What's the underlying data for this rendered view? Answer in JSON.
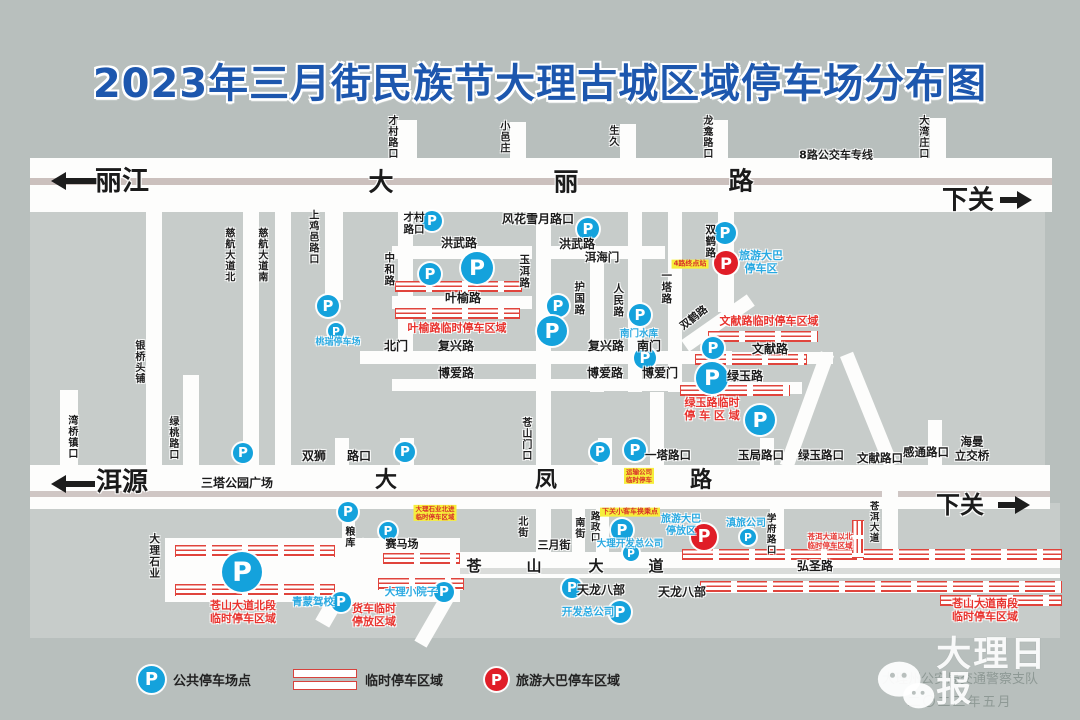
{
  "title": "2023年三月街民族节大理古城区域停车场分布图",
  "colors": {
    "accent_blue": "#1d57ae",
    "parking_blue": "#14a2dc",
    "bus_red": "#e01d27",
    "temp_zone_red": "#e8332e",
    "highlight_yellow": "#f6ee3b",
    "road_white": "#fdfdfc",
    "block_gray": "#c7ccca",
    "background": "#b8bfbd"
  },
  "legend": {
    "items": [
      {
        "icon": "blue-p",
        "label": "公共停车场点"
      },
      {
        "icon": "hatch",
        "label": "临时停车区域"
      },
      {
        "icon": "red-p",
        "label": "旅游大巴停车区域"
      }
    ]
  },
  "footer": {
    "watermark": "大理日报",
    "credit": "大理州公安局交通警察支队",
    "date": "二〇二三年五月"
  },
  "map": {
    "blocks": [
      {
        "x": 30,
        "y": 212,
        "w": 330,
        "h": 253
      },
      {
        "x": 360,
        "y": 212,
        "w": 360,
        "h": 253
      },
      {
        "x": 720,
        "y": 212,
        "w": 325,
        "h": 253
      },
      {
        "x": 30,
        "y": 503,
        "w": 1030,
        "h": 135
      }
    ],
    "roads": [
      {
        "x": 397,
        "y": 120,
        "w": 20,
        "h": 38
      },
      {
        "x": 510,
        "y": 122,
        "w": 16,
        "h": 36
      },
      {
        "x": 620,
        "y": 124,
        "w": 16,
        "h": 34
      },
      {
        "x": 712,
        "y": 120,
        "w": 16,
        "h": 38
      },
      {
        "x": 930,
        "y": 118,
        "w": 16,
        "h": 40
      },
      {
        "x": 30,
        "y": 158,
        "w": 1022,
        "h": 54,
        "stripe": {
          "top": 20,
          "h": 7,
          "color": "#cbc0bd"
        }
      },
      {
        "x": 392,
        "y": 246,
        "w": 140,
        "h": 13
      },
      {
        "x": 540,
        "y": 246,
        "w": 125,
        "h": 13
      },
      {
        "x": 392,
        "y": 296,
        "w": 140,
        "h": 13
      },
      {
        "x": 360,
        "y": 351,
        "w": 372,
        "h": 13
      },
      {
        "x": 688,
        "y": 352,
        "w": 145,
        "h": 12
      },
      {
        "x": 392,
        "y": 379,
        "w": 288,
        "h": 12
      },
      {
        "x": 680,
        "y": 382,
        "w": 122,
        "h": 12
      },
      {
        "x": 398,
        "y": 212,
        "w": 15,
        "h": 140
      },
      {
        "x": 536,
        "y": 212,
        "w": 15,
        "h": 255
      },
      {
        "x": 590,
        "y": 246,
        "w": 14,
        "h": 146
      },
      {
        "x": 628,
        "y": 212,
        "w": 14,
        "h": 180
      },
      {
        "x": 668,
        "y": 212,
        "w": 14,
        "h": 180
      },
      {
        "x": 650,
        "y": 392,
        "w": 14,
        "h": 75
      },
      {
        "x": 718,
        "y": 212,
        "w": 16,
        "h": 100
      },
      {
        "x": 678,
        "y": 316,
        "w": 80,
        "h": 14,
        "rot": -35
      },
      {
        "x": 60,
        "y": 390,
        "w": 18,
        "h": 77
      },
      {
        "x": 146,
        "y": 212,
        "w": 16,
        "h": 255
      },
      {
        "x": 183,
        "y": 375,
        "w": 16,
        "h": 92
      },
      {
        "x": 243,
        "y": 212,
        "w": 16,
        "h": 255
      },
      {
        "x": 275,
        "y": 212,
        "w": 16,
        "h": 255
      },
      {
        "x": 325,
        "y": 212,
        "w": 18,
        "h": 88
      },
      {
        "x": 335,
        "y": 438,
        "w": 14,
        "h": 29
      },
      {
        "x": 400,
        "y": 438,
        "w": 14,
        "h": 29
      },
      {
        "x": 598,
        "y": 438,
        "w": 14,
        "h": 29
      },
      {
        "x": 760,
        "y": 438,
        "w": 14,
        "h": 29
      },
      {
        "x": 928,
        "y": 420,
        "w": 14,
        "h": 47
      },
      {
        "x": 342,
        "y": 503,
        "w": 13,
        "h": 45
      },
      {
        "x": 800,
        "y": 350,
        "w": 14,
        "h": 120,
        "rot": 20
      },
      {
        "x": 862,
        "y": 350,
        "w": 14,
        "h": 120,
        "rot": -22
      },
      {
        "x": 30,
        "y": 465,
        "w": 1020,
        "h": 44,
        "stripe": {
          "top": 26,
          "h": 6,
          "color": "#cfc6c4"
        }
      },
      {
        "x": 536,
        "y": 503,
        "w": 15,
        "h": 50
      },
      {
        "x": 572,
        "y": 509,
        "w": 13,
        "h": 44
      },
      {
        "x": 596,
        "y": 509,
        "w": 13,
        "h": 44
      },
      {
        "x": 770,
        "y": 509,
        "w": 14,
        "h": 44
      },
      {
        "x": 882,
        "y": 467,
        "w": 16,
        "h": 90
      },
      {
        "x": 460,
        "y": 552,
        "w": 600,
        "h": 26,
        "stripe": {
          "top": 16,
          "h": 6,
          "color": "#dadcda"
        }
      },
      {
        "x": 165,
        "y": 538,
        "w": 295,
        "h": 64
      },
      {
        "x": 338,
        "y": 535,
        "w": 16,
        "h": 95,
        "rot": 30
      },
      {
        "x": 428,
        "y": 590,
        "w": 14,
        "h": 58,
        "rot": 30
      }
    ],
    "hatches": [
      {
        "x": 395,
        "y": 281,
        "w": 125,
        "h": 11
      },
      {
        "x": 395,
        "y": 308,
        "w": 123,
        "h": 11
      },
      {
        "x": 708,
        "y": 331,
        "w": 108,
        "h": 11
      },
      {
        "x": 695,
        "y": 354,
        "w": 110,
        "h": 11
      },
      {
        "x": 680,
        "y": 385,
        "w": 108,
        "h": 11
      },
      {
        "x": 175,
        "y": 545,
        "w": 158,
        "h": 12
      },
      {
        "x": 383,
        "y": 553,
        "w": 75,
        "h": 11
      },
      {
        "x": 175,
        "y": 584,
        "w": 158,
        "h": 12
      },
      {
        "x": 378,
        "y": 578,
        "w": 84,
        "h": 12
      },
      {
        "x": 682,
        "y": 549,
        "w": 378,
        "h": 11
      },
      {
        "x": 700,
        "y": 581,
        "w": 360,
        "h": 12
      },
      {
        "x": 940,
        "y": 595,
        "w": 120,
        "h": 11
      },
      {
        "x": 852,
        "y": 520,
        "w": 12,
        "h": 36,
        "v": 1
      }
    ],
    "arrows": [
      {
        "x": 57,
        "y": 178,
        "len": 40,
        "dir": "left"
      },
      {
        "x": 57,
        "y": 481,
        "len": 38,
        "dir": "left"
      },
      {
        "x": 1000,
        "y": 197,
        "len": 26,
        "dir": "right"
      },
      {
        "x": 998,
        "y": 502,
        "len": 26,
        "dir": "right"
      }
    ],
    "p_icons": [
      {
        "x": 432,
        "y": 221,
        "r": 10
      },
      {
        "x": 588,
        "y": 229,
        "r": 11
      },
      {
        "x": 725,
        "y": 233,
        "r": 11
      },
      {
        "x": 430,
        "y": 274,
        "r": 11
      },
      {
        "x": 477,
        "y": 268,
        "r": 16
      },
      {
        "x": 328,
        "y": 306,
        "r": 11
      },
      {
        "x": 336,
        "y": 331,
        "r": 8
      },
      {
        "x": 558,
        "y": 306,
        "r": 11
      },
      {
        "x": 552,
        "y": 331,
        "r": 15
      },
      {
        "x": 640,
        "y": 315,
        "r": 11
      },
      {
        "x": 645,
        "y": 358,
        "r": 11
      },
      {
        "x": 712,
        "y": 378,
        "r": 16
      },
      {
        "x": 243,
        "y": 453,
        "r": 10
      },
      {
        "x": 405,
        "y": 452,
        "r": 10
      },
      {
        "x": 600,
        "y": 452,
        "r": 10
      },
      {
        "x": 635,
        "y": 450,
        "r": 11
      },
      {
        "x": 713,
        "y": 348,
        "r": 11
      },
      {
        "x": 760,
        "y": 420,
        "r": 15
      },
      {
        "x": 348,
        "y": 512,
        "r": 10
      },
      {
        "x": 388,
        "y": 531,
        "r": 9
      },
      {
        "x": 242,
        "y": 572,
        "r": 20
      },
      {
        "x": 341,
        "y": 602,
        "r": 10
      },
      {
        "x": 444,
        "y": 592,
        "r": 10
      },
      {
        "x": 572,
        "y": 588,
        "r": 10
      },
      {
        "x": 620,
        "y": 612,
        "r": 11
      },
      {
        "x": 622,
        "y": 530,
        "r": 11
      },
      {
        "x": 631,
        "y": 553,
        "r": 8
      },
      {
        "x": 748,
        "y": 537,
        "r": 8
      },
      {
        "x": 726,
        "y": 263,
        "r": 12,
        "kind": "red"
      },
      {
        "x": 704,
        "y": 537,
        "r": 13,
        "kind": "red"
      }
    ],
    "labels": [
      {
        "t": "丽江",
        "x": 122,
        "y": 182,
        "s": 27
      },
      {
        "t": "大",
        "x": 381,
        "y": 182,
        "s": 25
      },
      {
        "t": "丽",
        "x": 566,
        "y": 182,
        "s": 25
      },
      {
        "t": "路",
        "x": 741,
        "y": 181,
        "s": 25
      },
      {
        "t": "下关",
        "x": 968,
        "y": 201,
        "s": 26
      },
      {
        "t": "8路公交车专线",
        "x": 836,
        "y": 156,
        "s": 11
      },
      {
        "t": "才村\n路口",
        "x": 414,
        "y": 224,
        "s": 10.5
      },
      {
        "t": "风花雪月路口",
        "x": 538,
        "y": 219,
        "s": 12
      },
      {
        "t": "洪武路",
        "x": 459,
        "y": 243,
        "s": 12
      },
      {
        "t": "洪武路",
        "x": 577,
        "y": 244,
        "s": 12
      },
      {
        "t": "洱海门",
        "x": 602,
        "y": 258,
        "s": 11.5
      },
      {
        "t": "叶榆路",
        "x": 463,
        "y": 298,
        "s": 12
      },
      {
        "t": "北门",
        "x": 396,
        "y": 346,
        "s": 12
      },
      {
        "t": "复兴路",
        "x": 456,
        "y": 346,
        "s": 12
      },
      {
        "t": "复兴路",
        "x": 606,
        "y": 346,
        "s": 12
      },
      {
        "t": "南门",
        "x": 649,
        "y": 346,
        "s": 12
      },
      {
        "t": "博爱路",
        "x": 456,
        "y": 373,
        "s": 12
      },
      {
        "t": "博爱路",
        "x": 605,
        "y": 373,
        "s": 12
      },
      {
        "t": "博爱门",
        "x": 660,
        "y": 373,
        "s": 12
      },
      {
        "t": "文献路",
        "x": 770,
        "y": 349,
        "s": 12
      },
      {
        "t": "绿玉路",
        "x": 745,
        "y": 376,
        "s": 12
      },
      {
        "t": "双狮",
        "x": 314,
        "y": 456,
        "s": 12
      },
      {
        "t": "路口",
        "x": 359,
        "y": 456,
        "s": 12
      },
      {
        "t": "三塔公园广场",
        "x": 237,
        "y": 483,
        "s": 12
      },
      {
        "t": "洱源",
        "x": 122,
        "y": 483,
        "s": 26
      },
      {
        "t": "大",
        "x": 386,
        "y": 481,
        "s": 22
      },
      {
        "t": "凤",
        "x": 546,
        "y": 481,
        "s": 22
      },
      {
        "t": "路",
        "x": 701,
        "y": 481,
        "s": 22
      },
      {
        "t": "下关",
        "x": 960,
        "y": 505,
        "s": 24
      },
      {
        "t": "一塔路口",
        "x": 668,
        "y": 456,
        "s": 11.5
      },
      {
        "t": "玉局路口",
        "x": 761,
        "y": 456,
        "s": 11.5
      },
      {
        "t": "绿玉路口",
        "x": 821,
        "y": 456,
        "s": 11.5
      },
      {
        "t": "文献路口",
        "x": 880,
        "y": 459,
        "s": 11.5
      },
      {
        "t": "感通路口",
        "x": 926,
        "y": 453,
        "s": 11.5
      },
      {
        "t": "海曼\n立交桥",
        "x": 972,
        "y": 449,
        "s": 11.5
      },
      {
        "t": "三月街",
        "x": 554,
        "y": 546,
        "s": 11
      },
      {
        "t": "赛马场",
        "x": 402,
        "y": 545,
        "s": 11
      },
      {
        "t": "苍",
        "x": 474,
        "y": 567,
        "s": 15
      },
      {
        "t": "山",
        "x": 534,
        "y": 567,
        "s": 15
      },
      {
        "t": "大",
        "x": 596,
        "y": 567,
        "s": 15
      },
      {
        "t": "道",
        "x": 656,
        "y": 567,
        "s": 15
      },
      {
        "t": "弘圣路",
        "x": 815,
        "y": 566,
        "s": 12
      },
      {
        "t": "天龙八部",
        "x": 601,
        "y": 590,
        "s": 12
      },
      {
        "t": "天龙八部",
        "x": 682,
        "y": 592,
        "s": 12
      },
      {
        "t": "才村路口",
        "x": 391,
        "y": 137,
        "s": 10,
        "v": 1
      },
      {
        "t": "小邑庄",
        "x": 503,
        "y": 137,
        "s": 10,
        "v": 1
      },
      {
        "t": "生久",
        "x": 612,
        "y": 136,
        "s": 10,
        "v": 1
      },
      {
        "t": "龙龛路口",
        "x": 706,
        "y": 137,
        "s": 10,
        "v": 1
      },
      {
        "t": "大湾庄口",
        "x": 922,
        "y": 137,
        "s": 10,
        "v": 1
      },
      {
        "t": "慈航大道北",
        "x": 228,
        "y": 255,
        "s": 10,
        "v": 1
      },
      {
        "t": "慈航大道南",
        "x": 261,
        "y": 255,
        "s": 10,
        "v": 1
      },
      {
        "t": "上鸡邑路口",
        "x": 312,
        "y": 237,
        "s": 10,
        "v": 1
      },
      {
        "t": "中和路",
        "x": 389,
        "y": 269,
        "s": 10.5,
        "v": 1
      },
      {
        "t": "玉洱路",
        "x": 524,
        "y": 271,
        "s": 10.5,
        "v": 1
      },
      {
        "t": "护国路",
        "x": 579,
        "y": 298,
        "s": 10.5,
        "v": 1
      },
      {
        "t": "人民路",
        "x": 618,
        "y": 300,
        "s": 10.5,
        "v": 1
      },
      {
        "t": "一塔路",
        "x": 666,
        "y": 287,
        "s": 10.5,
        "v": 1
      },
      {
        "t": "双鹤路",
        "x": 710,
        "y": 241,
        "s": 10.5,
        "v": 1
      },
      {
        "t": "双鹤路",
        "x": 694,
        "y": 318,
        "s": 10.5,
        "rot": -38
      },
      {
        "t": "银桥头铺",
        "x": 138,
        "y": 362,
        "s": 10,
        "v": 1
      },
      {
        "t": "湾桥镇口",
        "x": 71,
        "y": 437,
        "s": 10,
        "v": 1
      },
      {
        "t": "绿桃路口",
        "x": 172,
        "y": 438,
        "s": 10,
        "v": 1
      },
      {
        "t": "苍山门口",
        "x": 525,
        "y": 439,
        "s": 10,
        "v": 1
      },
      {
        "t": "大理石业",
        "x": 154,
        "y": 556,
        "s": 10.5,
        "v": 1
      },
      {
        "t": "粮库",
        "x": 348,
        "y": 537,
        "s": 10,
        "v": 1
      },
      {
        "t": "北街",
        "x": 521,
        "y": 527,
        "s": 10,
        "v": 1
      },
      {
        "t": "南街",
        "x": 578,
        "y": 528,
        "s": 10,
        "v": 1
      },
      {
        "t": "路政口",
        "x": 594,
        "y": 527,
        "s": 9.5,
        "v": 1
      },
      {
        "t": "学府路口",
        "x": 770,
        "y": 534,
        "s": 9.5,
        "v": 1
      },
      {
        "t": "苍洱大道",
        "x": 873,
        "y": 522,
        "s": 9.5,
        "v": 1
      },
      {
        "t": "叶榆路临时停车区域",
        "x": 457,
        "y": 329,
        "s": 11,
        "c": "r"
      },
      {
        "t": "文献路临时停车区域",
        "x": 769,
        "y": 322,
        "s": 11,
        "c": "r"
      },
      {
        "t": "绿玉路临时\n停 车 区 域",
        "x": 712,
        "y": 410,
        "s": 11,
        "c": "r"
      },
      {
        "t": "苍山大道北段\n临时停车区域",
        "x": 243,
        "y": 613,
        "s": 11,
        "c": "r"
      },
      {
        "t": "货车临时\n停放区域",
        "x": 374,
        "y": 616,
        "s": 11,
        "c": "r"
      },
      {
        "t": "苍洱大道以北\n临时停车区域",
        "x": 830,
        "y": 542,
        "s": 7.5,
        "c": "r"
      },
      {
        "t": "苍山大道南段\n临时停车区域",
        "x": 985,
        "y": 611,
        "s": 11,
        "c": "r"
      },
      {
        "t": "桃瑞停车场",
        "x": 338,
        "y": 343,
        "s": 9,
        "c": "b"
      },
      {
        "t": "南门水库",
        "x": 639,
        "y": 334,
        "s": 9.5,
        "c": "b"
      },
      {
        "t": "旅游大巴\n停车区",
        "x": 761,
        "y": 263,
        "s": 11,
        "c": "b"
      },
      {
        "t": "旅游大巴\n停放区",
        "x": 681,
        "y": 526,
        "s": 10,
        "c": "b"
      },
      {
        "t": "滇旅公司",
        "x": 746,
        "y": 524,
        "s": 10,
        "c": "b"
      },
      {
        "t": "大理开发总公司",
        "x": 630,
        "y": 544,
        "s": 9.5,
        "c": "b"
      },
      {
        "t": "开发总公司",
        "x": 588,
        "y": 612,
        "s": 10.5,
        "c": "b"
      },
      {
        "t": "青蒙驾校",
        "x": 313,
        "y": 602,
        "s": 10.5,
        "c": "b"
      },
      {
        "t": "大理小院子",
        "x": 411,
        "y": 592,
        "s": 10.5,
        "c": "b"
      },
      {
        "t": "4路终点站",
        "x": 690,
        "y": 264,
        "s": 7,
        "c": "y"
      },
      {
        "t": "下关小客车换乘点",
        "x": 630,
        "y": 512,
        "s": 7,
        "c": "y"
      },
      {
        "t": "大理石业北进\n临时停车区域",
        "x": 435,
        "y": 513,
        "s": 6.5,
        "c": "y"
      },
      {
        "t": "运输公司\n临时停车",
        "x": 639,
        "y": 476,
        "s": 6.5,
        "c": "y"
      }
    ]
  }
}
